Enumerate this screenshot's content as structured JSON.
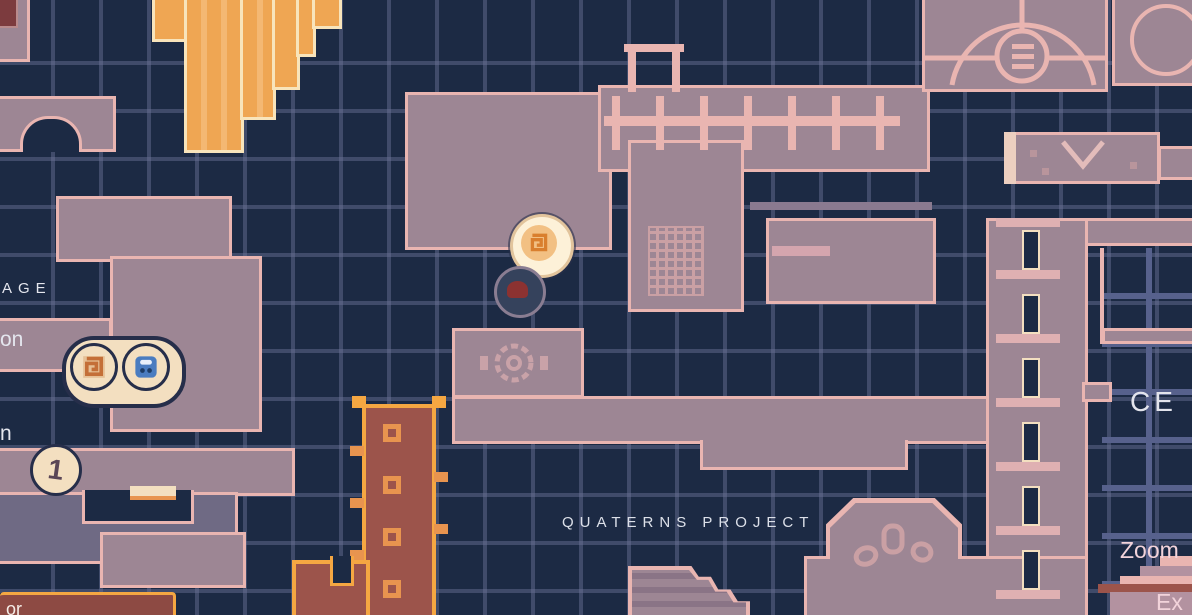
{
  "labels": {
    "area_top_left_partial": "AGE",
    "room_left_word_partial_a": "on",
    "room_left_word_partial_b": "n",
    "area_center": "QUATERNS PROJECT",
    "area_right_partial": "CE",
    "control_zoom": "Zoom",
    "control_exit_partial": "Ex",
    "label_box_partial": "or",
    "marker_number_glyph": "1"
  },
  "markers": {
    "twin_pill": {
      "left_icon": "spiral-rune-marker",
      "right_icon": "save-terminal-marker"
    },
    "numbered_coin": "number-flag-marker",
    "glowing_rune": "active-spiral-marker",
    "dim_flame": "extinguished-flame-marker"
  },
  "colors": {
    "background": "#1c2a44",
    "grid_line": "#6c739b",
    "room_fill": "#9d8694",
    "room_outline": "#e9b5b1",
    "room_fill_dim": "#6f6a84",
    "orange_block": "#efa653",
    "orange_edge": "#f8e4bb",
    "orange_bright": "#f5a742",
    "brick_red": "#9c544b",
    "maroon": "#7c3b3e",
    "marker_cream": "#f3dfc0",
    "marker_outline": "#262e4a",
    "marker_blue": "#4a7cc0",
    "marker_orange_glyph": "#c46f38",
    "marker_red_blob": "#8c3231",
    "text_light": "#e4e6ee",
    "text_pink": "#f2d3da",
    "label_box_fill": "#8d4a43"
  }
}
